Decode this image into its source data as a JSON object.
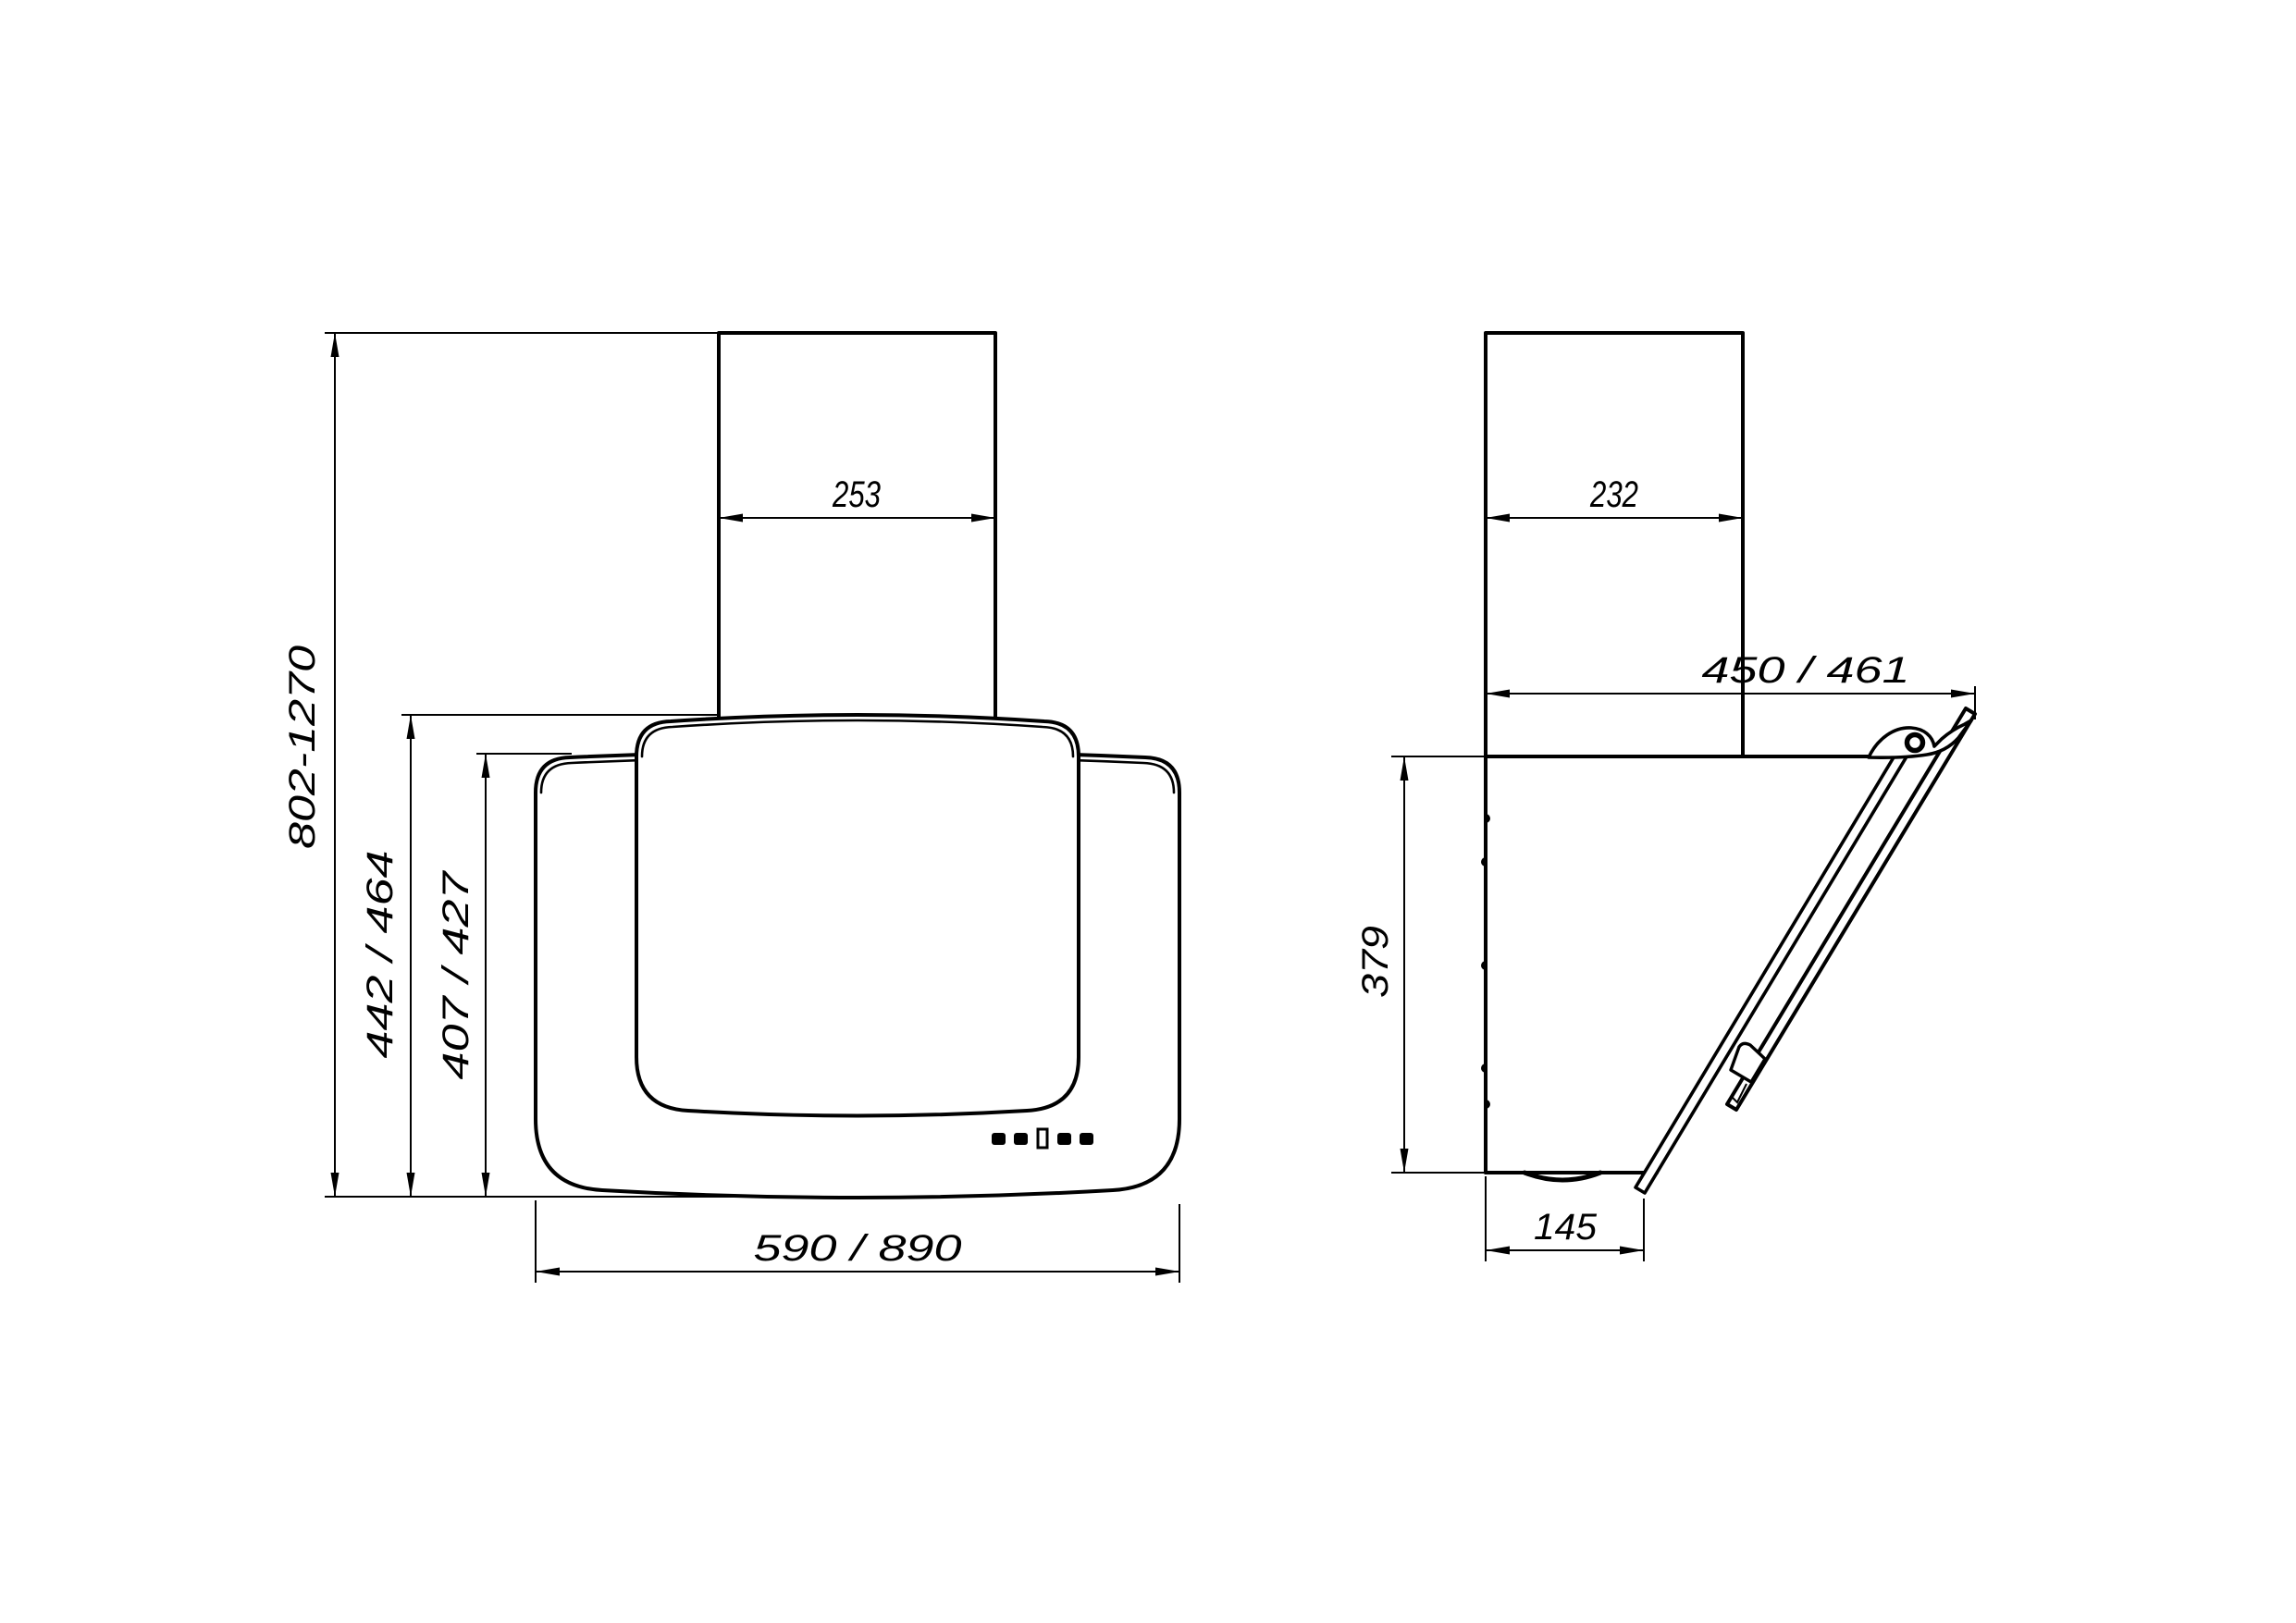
{
  "page": {
    "background_color": "#ffffff",
    "line_color": "#000000",
    "description": "Technical dimension drawing of a wall-mounted kitchen cooker hood with inclined glass front: front view (left) and side view (right)"
  },
  "views": {
    "front": {
      "name": "front-view"
    },
    "side": {
      "name": "side-view"
    }
  },
  "dims": {
    "chimney_width": "253",
    "height_range": "802-1270",
    "body_height": "442 / 464",
    "glass_height": "407 / 427",
    "hood_width": "590 / 890",
    "chimney_depth": "232",
    "total_depth": "450 / 461",
    "back_height": "379",
    "bottom_depth": "145"
  },
  "controls": {
    "buttons_total": 5,
    "square_buttons": 4,
    "display_windows": 1
  }
}
